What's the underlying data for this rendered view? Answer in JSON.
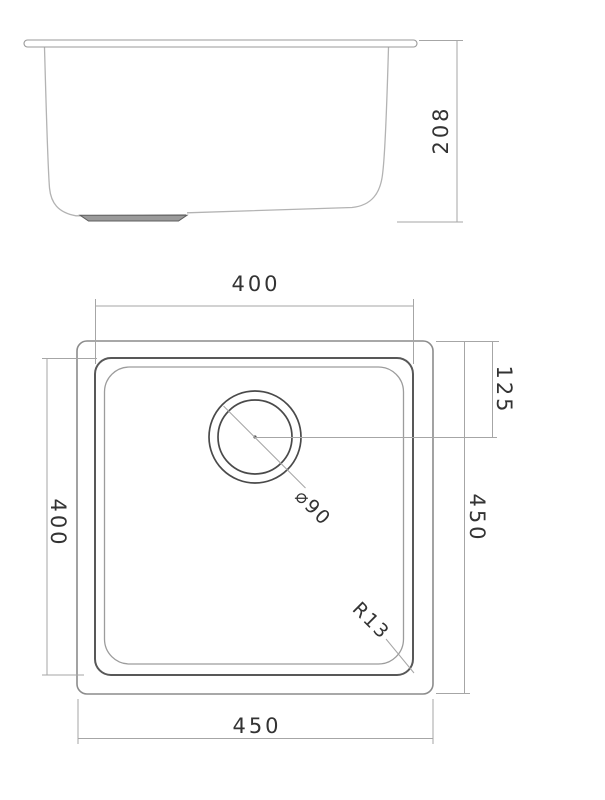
{
  "drawing": {
    "type": "technical-drawing-sink",
    "side_view": {
      "height": "208"
    },
    "plan_view": {
      "top_width": "400",
      "left_height": "400",
      "right_height": "450",
      "bottom_width": "450",
      "drain_offset": "125",
      "drain_diameter": "⌀90",
      "corner_radius": "R13"
    },
    "colors": {
      "background": "#ffffff",
      "outline_gray": "#8c8c8c",
      "bowl_line_gray": "#585858",
      "dimension_line_gray": "#a6a6a6",
      "text_gray": "#333333"
    }
  }
}
